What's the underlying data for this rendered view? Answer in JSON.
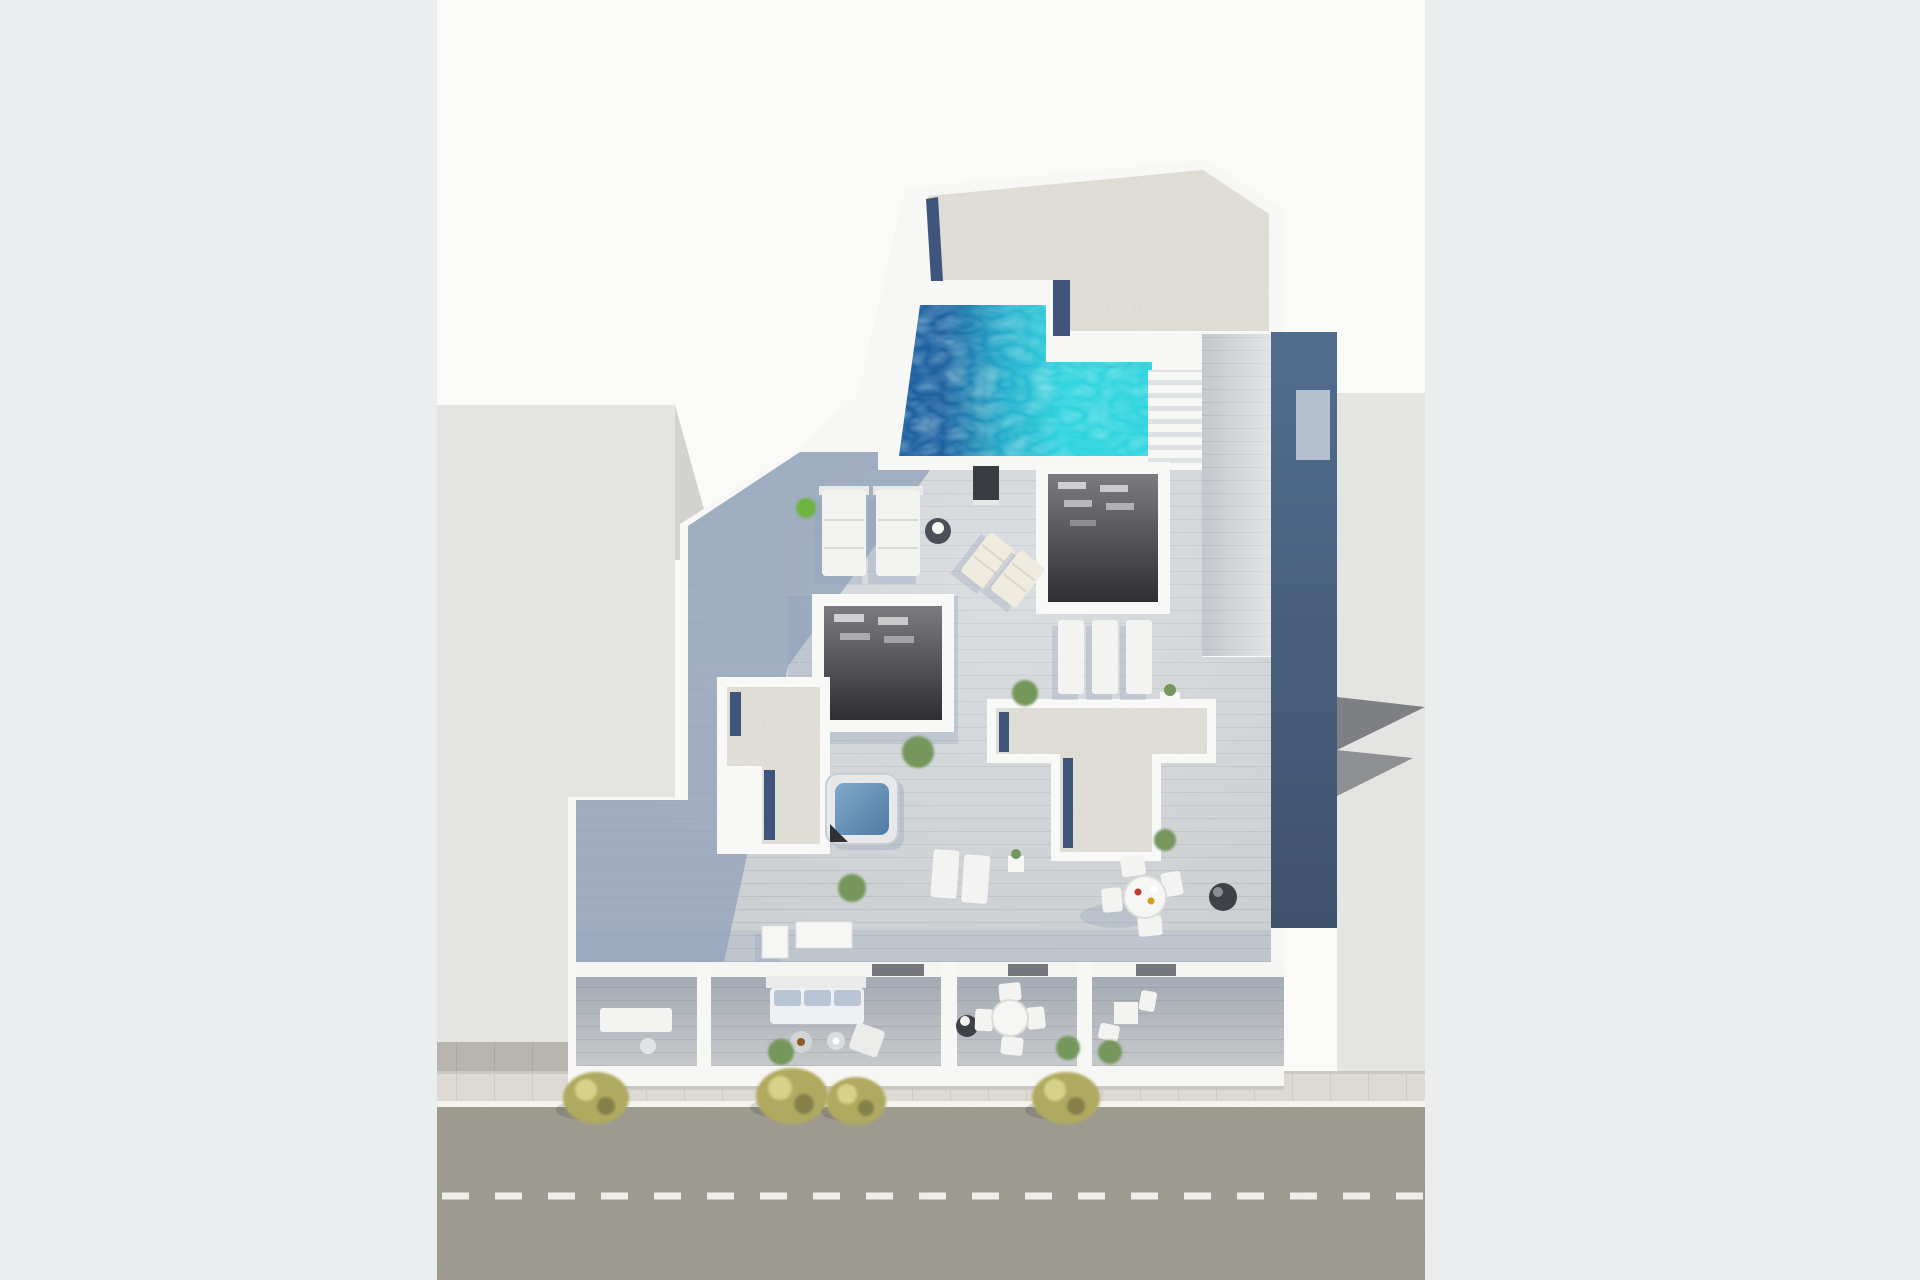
{
  "scene": {
    "description": "Aerial 3D architectural render of an apartment building rooftop floor plan with swimming pool, hot tub, gravel terraces, wood decks, street-level balconies and a road below",
    "view": "top-down aerial",
    "no_visible_text": true
  },
  "labels": {
    "stage": "3D aerial render of rooftop floor plan",
    "pool": "rooftop swimming pool",
    "poolStairs": "staircase beside pool",
    "gravelTop": "upper gravel roof terrace",
    "terrace1": "left gravel terrace",
    "terrace2": "center-right gravel terrace",
    "jacuzzi": "hot tub",
    "voidA": "stairwell opening right",
    "voidB": "stairwell opening center",
    "deck": "sun-lit wood roof deck",
    "walkway": "wood walkway along right side",
    "navyWall": "shaded east wall",
    "balconies": "street-facing balconies",
    "street": "asphalt street with dashed lane line",
    "sidewalk": "sidewalk with curb",
    "leftBuilding": "neighboring building left",
    "rightBuilding": "neighboring building right",
    "trees": "street trees",
    "daybeds": "two quilted daybeds",
    "sunbeds": "row of three sunbeds",
    "loungers": "folding sun loungers",
    "diningSet": "round outdoor dining set",
    "sofa": "balcony sofa",
    "grill": "round grill pot"
  },
  "palette": {
    "pageBg": "#ecedee",
    "band": "#fafaf9",
    "neighbor": "#e4e4e2",
    "neighborWedge": "#d3d2d0",
    "shadowDark": "#7e7f83",
    "shadowMid": "#8f9094",
    "sidewalk": "#dcdad3",
    "curb": "#f3f2ed",
    "pavers": "#b7b5ae",
    "asphalt": "#9c9a8e",
    "laneDash": "#eeede7",
    "slab": "#f7f7f5",
    "gravel": "#e6e4dc",
    "pebble": "#3f557c",
    "poolDeep": "#1b5fa0",
    "poolMid": "#21aecb",
    "poolLight": "#2bd3de",
    "woodLit": "#ccd0d3",
    "walkway": "#c4c8cc",
    "deckShadow": "#8fa0b9",
    "navyTop": "#516d8e",
    "navyBottom": "#3f526c",
    "voidTop": "#7b7b80",
    "voidBottom": "#2e2e33",
    "lightBar": "#d9d9db",
    "balconyTop": "#9fa6b0",
    "balconyBottom": "#c7c9cb",
    "furnWhite": "#f3f3f1",
    "cushion": "#b9c4d4",
    "potDark": "#3e4146",
    "treeBase": "#b0aa60",
    "treeLight": "#d6d288",
    "treeDark": "#83814a",
    "plantGreen": "#74975c",
    "plantBright": "#6db33f",
    "jacuzziLight": "#7fa9c9",
    "jacuzziDeep": "#4f7aa3",
    "towel": "#2e3237",
    "matDark": "#393c41"
  }
}
